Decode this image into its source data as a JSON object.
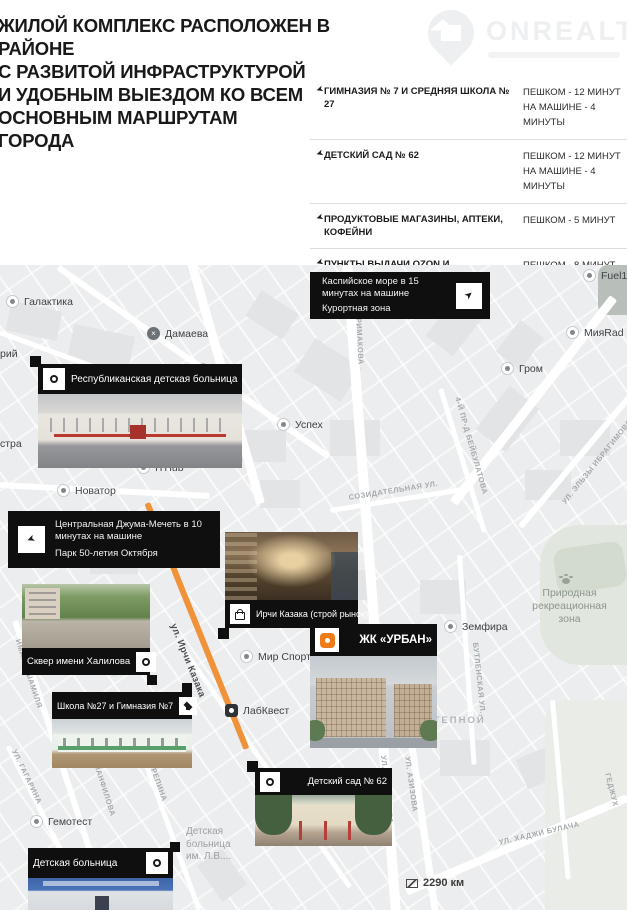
{
  "header": {
    "headline": "ЖИЛОЙ КОМПЛЕКС РАСПОЛОЖЕН В РАЙОНЕ\nС РАЗВИТОЙ ИНФРАСТРУКТУРОЙ\nИ УДОБНЫМ ВЫЕЗДОМ КО ВСЕМ\nОСНОВНЫМ МАРШРУТАМ\nГОРОДА",
    "logo_text": "ONREALT"
  },
  "infrastructure": {
    "rows": [
      {
        "label": "ГИМНАЗИЯ № 7 И СРЕДНЯЯ ШКОЛА № 27",
        "times": [
          "ПЕШКОМ - 12 МИНУТ",
          "НА МАШИНЕ - 4 МИНУТЫ"
        ]
      },
      {
        "label": "ДЕТСКИЙ САД № 62",
        "times": [
          "ПЕШКОМ - 12 МИНУТ",
          "НА МАШИНЕ - 4 МИНУТЫ"
        ]
      },
      {
        "label": "ПРОДУКТОВЫЕ МАГАЗИНЫ, АПТЕКИ, КОФЕЙНИ",
        "times": [
          "ПЕШКОМ - 5 МИНУТ"
        ]
      },
      {
        "label": "ПУНКТЫ ВЫДАЧИ OZON И WILDBERRIES",
        "times": [
          "ПЕШКОМ - 8 МИНУТ"
        ]
      },
      {
        "label": "ТРЦ, РЕСТОРАНЫ, КАФЕ",
        "times": [
          "ПЕШКОМ - 3 МИНУТЫ"
        ]
      }
    ]
  },
  "callouts": {
    "caspian": {
      "line1": "Каспийское море в 15 минутах на машине",
      "line2": "Курортная зона"
    },
    "mosque": {
      "line1": "Центральная Джума-Мечеть в 10 минутах на машине",
      "line2": "Парк 50-летия Октября"
    },
    "hospital": {
      "label": "Республиканская детская больница"
    },
    "market": {
      "label": "Ирчи Казака (строй рынок)"
    },
    "skver": {
      "label": "Сквер имени Халилова"
    },
    "school": {
      "label": "Школа №27 и Гимназия №7"
    },
    "urban": {
      "label": "ЖК «УРБАН»"
    },
    "kindergarten": {
      "label": "Детский сад № 62"
    },
    "children_hospital": {
      "label": "Детская больница"
    }
  },
  "map": {
    "pois": [
      {
        "label": "Галактика"
      },
      {
        "label": "Дамаева"
      },
      {
        "label": "Успех"
      },
      {
        "label": "ITHub"
      },
      {
        "label": "Новатор"
      },
      {
        "label": "Гром"
      },
      {
        "label": "МияRad"
      },
      {
        "label": "Fuel1"
      },
      {
        "label": "Земфира"
      },
      {
        "label": "Мир Спорта"
      },
      {
        "label": "ЛабКвест"
      },
      {
        "label": "Гемотест"
      }
    ],
    "streets": [
      "просп. ГАМИДОВА",
      "ул. ПРИМАКОВА",
      "ул. ПРИМАКОВА",
      "ул. АЗИЗОВА",
      "ул. ХАДЖИ БУЛАЧА",
      "4-й пр-д БЕЙБУЛАТОВА",
      "СОЗИДАТЕЛЬНАЯ ул.",
      "ул. ЭЛЬЗЫ ИБРАГИМОВОЙ",
      "БУТЛЕНСКАЯ ул.",
      "ул. Ирчи Казака",
      "ИМАМА ШАМИЛЯ",
      "ул. ГАГАРИНА",
      "ул. ПАНФИЛОВА",
      "ул. РЕПИНА",
      "ГЕДЖУХ"
    ],
    "areas": {
      "nature_zone": "Природная\nрекреационная\nзона",
      "stepnoy": "СТЕПНОЙ",
      "hospital_lv": "Детская\nбольница\nим. Л.В...."
    },
    "partials": [
      "рий",
      "стра"
    ],
    "scale": "2290 км",
    "damaeva_glyph": "×"
  },
  "colors": {
    "accent_orange": "#ee7c1b",
    "road_orange": "#f0923a",
    "bar_black": "#0f0f0f"
  }
}
